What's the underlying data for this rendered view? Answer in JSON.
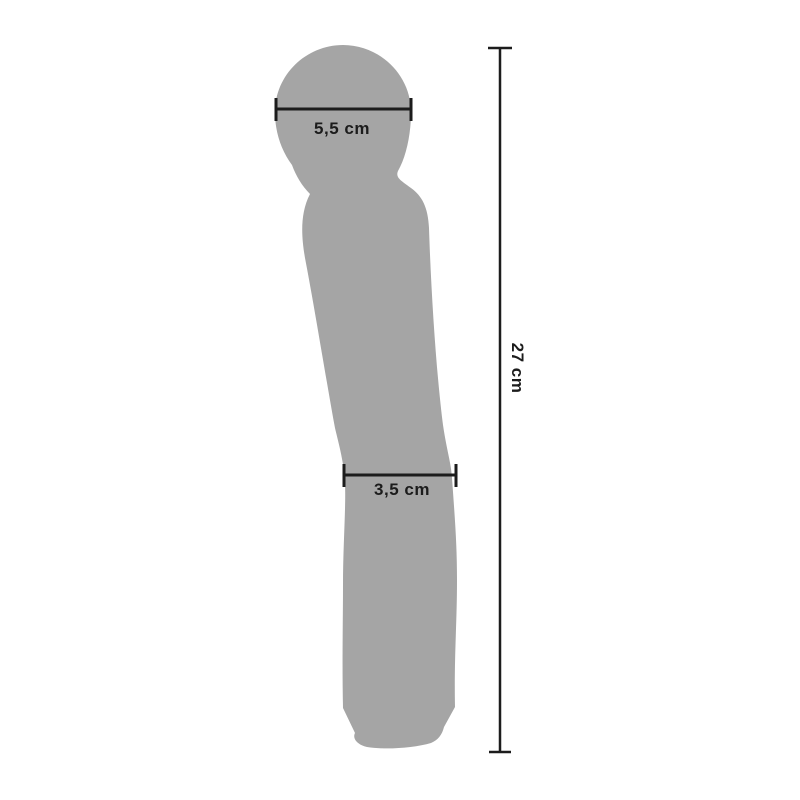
{
  "diagram": {
    "background_color": "#ffffff",
    "silhouette_color": "#a5a5a5",
    "line_color": "#1c1c1c",
    "text_color": "#1c1c1c",
    "measurements": {
      "head_width": "5,5 cm",
      "shaft_width": "3,5 cm",
      "total_length": "27 cm"
    }
  }
}
